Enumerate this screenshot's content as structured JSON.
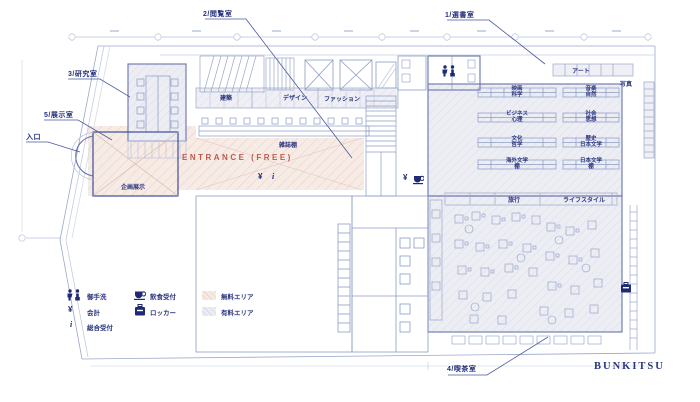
{
  "brand": "BUNKITSU",
  "rooms": {
    "selection": "1/選書室",
    "reading": "2/閲覧室",
    "research": "3/研究室",
    "cafe": "4/喫茶室",
    "exhibition": "5/展示室",
    "entrance": "入口"
  },
  "areas": {
    "entrance_free": "ENTRANCE (FREE)",
    "planned_exhibition": "企画展示",
    "magazine_shelf": "雑誌棚"
  },
  "shelves": {
    "architecture": "建築",
    "design": "デザイン",
    "fashion": "ファッション",
    "art": "アート",
    "photo": "写真",
    "travel": "旅行",
    "lifestyle": "ライフスタイル",
    "pairs": [
      {
        "top": "映画",
        "bottom": "科学"
      },
      {
        "top": "音楽",
        "bottom": "自然"
      },
      {
        "top": "ビジネス",
        "bottom": "心理"
      },
      {
        "top": "社会",
        "bottom": "思想"
      },
      {
        "top": "文化",
        "bottom": "哲学"
      },
      {
        "top": "歴史",
        "bottom": "日本文学"
      },
      {
        "top": "海外文学",
        "bottom": "棚"
      },
      {
        "top": "日本文学",
        "bottom": "棚"
      }
    ]
  },
  "legend": {
    "restroom": "御手洗",
    "cashier": "会計",
    "reception": "総合受付",
    "food_counter": "飲食受付",
    "locker": "ロッカー",
    "free_area": "無料エリア",
    "paid_area": "有料エリア"
  },
  "symbols": {
    "yen": "¥",
    "info": "i"
  },
  "colors": {
    "navy": "#2a357e",
    "line": "#8b9cc4",
    "free_area": "#f4e4de",
    "paid_area": "#e9e9f2",
    "accent_red": "#bf5a4d"
  }
}
